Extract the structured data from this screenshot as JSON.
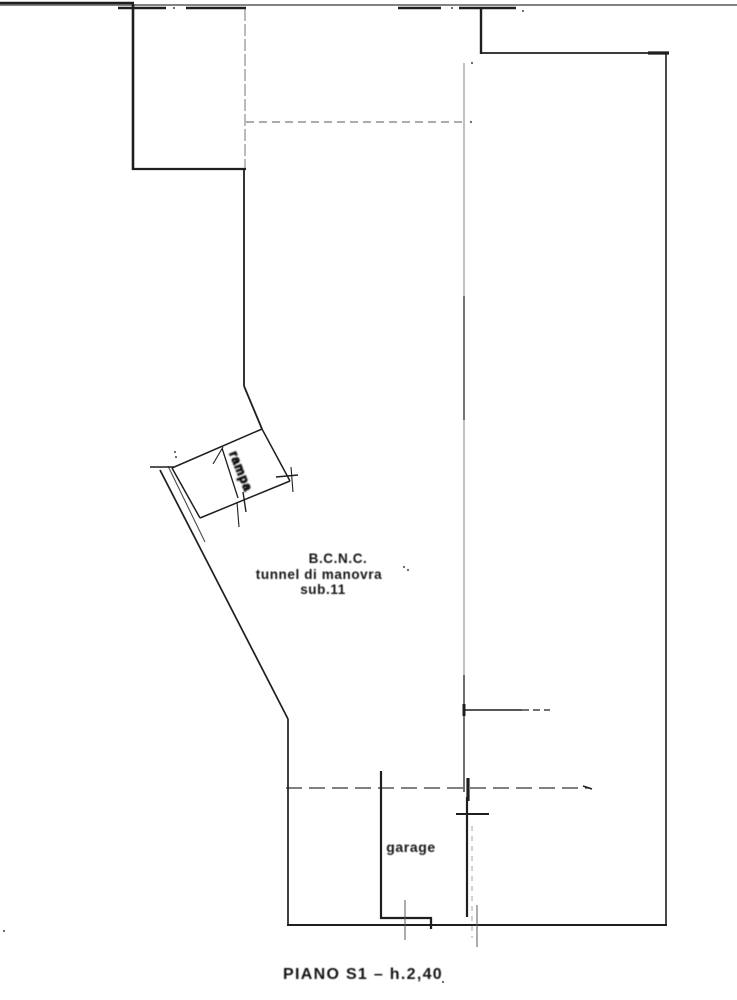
{
  "page": {
    "width": 737,
    "height": 1000,
    "background": "#ffffff"
  },
  "drawing": {
    "kind": "cadastral-floor-plan",
    "caption": "PIANO S1 – h.2,40",
    "unit_label_lines": [
      "B.C.N.C.",
      "tunnel di manovra",
      "sub.11"
    ],
    "garage_label": "garage",
    "ramp_label": "rampa"
  },
  "colors": {
    "ink": "#1f1f1f",
    "soft": "#5a5a5a",
    "paper": "#ffffff"
  },
  "plan": {
    "lines": [
      {
        "x1": 0,
        "y1": 5,
        "x2": 737,
        "y2": 5,
        "w": 1.5,
        "c": "soft",
        "n": "sheet-top-border"
      },
      {
        "x1": 0,
        "y1": 3,
        "x2": 134,
        "y2": 3,
        "w": 2.6,
        "n": "sheet-top-border-dark"
      },
      {
        "x1": 118,
        "y1": 8,
        "x2": 166,
        "y2": 8,
        "w": 2.6,
        "n": "top-wall-segment"
      },
      {
        "x1": 186,
        "y1": 8,
        "x2": 246,
        "y2": 8,
        "w": 2.6,
        "n": "top-wall-segment"
      },
      {
        "x1": 398,
        "y1": 8,
        "x2": 441,
        "y2": 8,
        "w": 2.6,
        "n": "top-wall-segment"
      },
      {
        "x1": 459,
        "y1": 8,
        "x2": 516,
        "y2": 8,
        "w": 2.6,
        "n": "top-wall-segment"
      },
      {
        "x1": 133,
        "y1": 4,
        "x2": 133,
        "y2": 170,
        "w": 2.6,
        "n": "room-wall-left"
      },
      {
        "x1": 132,
        "y1": 169,
        "x2": 246,
        "y2": 169,
        "w": 2.3,
        "n": "room-wall-bottom"
      },
      {
        "x1": 245,
        "y1": 9,
        "x2": 245,
        "y2": 168,
        "w": 1.1,
        "c": "soft",
        "o": 0.75,
        "d": "12,3",
        "n": "room-wall-right-thin"
      },
      {
        "x1": 244,
        "y1": 169,
        "x2": 244,
        "y2": 386,
        "w": 1.8,
        "n": "tunnel-wall-left"
      },
      {
        "x1": 244,
        "y1": 386,
        "x2": 262,
        "y2": 429,
        "w": 1.8,
        "n": "tunnel-wall-kink"
      },
      {
        "x1": 481,
        "y1": 7,
        "x2": 481,
        "y2": 54,
        "w": 2.4,
        "n": "top-right-wall-vertical"
      },
      {
        "x1": 480,
        "y1": 53,
        "x2": 668,
        "y2": 53,
        "w": 1.8,
        "n": "top-right-wall-horizontal"
      },
      {
        "x1": 648,
        "y1": 53,
        "x2": 669,
        "y2": 53,
        "w": 3.2,
        "n": "wall-tick"
      },
      {
        "x1": 666,
        "y1": 53,
        "x2": 666,
        "y2": 925,
        "w": 1.6,
        "n": "outer-wall-right"
      },
      {
        "x1": 262,
        "y1": 429,
        "x2": 172,
        "y2": 468,
        "w": 1.5,
        "n": "ramp-edge-top"
      },
      {
        "x1": 172,
        "y1": 468,
        "x2": 200,
        "y2": 518,
        "w": 1.5,
        "n": "ramp-edge-left"
      },
      {
        "x1": 200,
        "y1": 518,
        "x2": 290,
        "y2": 481,
        "w": 1.5,
        "n": "ramp-edge-bottom"
      },
      {
        "x1": 290,
        "y1": 481,
        "x2": 262,
        "y2": 429,
        "w": 1.5,
        "n": "ramp-edge-right"
      },
      {
        "x1": 222,
        "y1": 448,
        "x2": 238,
        "y2": 498,
        "w": 1.3,
        "n": "ramp-division-line"
      },
      {
        "x1": 213,
        "y1": 464,
        "x2": 223,
        "y2": 447,
        "w": 1.1,
        "n": "ramp-mark"
      },
      {
        "x1": 150,
        "y1": 467,
        "x2": 174,
        "y2": 467,
        "w": 1.4,
        "n": "wall-tick"
      },
      {
        "x1": 276,
        "y1": 477,
        "x2": 298,
        "y2": 475,
        "w": 1.4,
        "n": "wall-tick"
      },
      {
        "x1": 291,
        "y1": 467,
        "x2": 293,
        "y2": 492,
        "w": 1.1,
        "n": "wall-tick"
      },
      {
        "x1": 243,
        "y1": 492,
        "x2": 246,
        "y2": 512,
        "w": 1.4,
        "n": "ramp-mark"
      },
      {
        "x1": 237,
        "y1": 502,
        "x2": 239,
        "y2": 527,
        "w": 1.1,
        "n": "ramp-mark"
      },
      {
        "x1": 160,
        "y1": 470,
        "x2": 288,
        "y2": 719,
        "w": 1.7,
        "n": "outer-wall-diagonal"
      },
      {
        "x1": 168,
        "y1": 466,
        "x2": 205,
        "y2": 542,
        "w": 1.1,
        "o": 0.8,
        "n": "outer-wall-diagonal-inner"
      },
      {
        "x1": 288,
        "y1": 719,
        "x2": 288,
        "y2": 926,
        "w": 1.7,
        "n": "outer-wall-left"
      },
      {
        "x1": 287,
        "y1": 925,
        "x2": 667,
        "y2": 925,
        "w": 1.9,
        "n": "outer-wall-bottom"
      },
      {
        "x1": 381,
        "y1": 771,
        "x2": 381,
        "y2": 919,
        "w": 2.2,
        "n": "garage-wall-left"
      },
      {
        "x1": 380,
        "y1": 918,
        "x2": 432,
        "y2": 918,
        "w": 2.3,
        "n": "garage-sill"
      },
      {
        "x1": 431,
        "y1": 917,
        "x2": 431,
        "y2": 929,
        "w": 2.3,
        "n": "garage-sill-step"
      },
      {
        "x1": 467,
        "y1": 797,
        "x2": 467,
        "y2": 917,
        "w": 2.2,
        "n": "garage-wall-right"
      },
      {
        "x1": 456,
        "y1": 814,
        "x2": 489,
        "y2": 814,
        "w": 2,
        "n": "garage-door-jamb"
      },
      {
        "x1": 468,
        "y1": 778,
        "x2": 468,
        "y2": 801,
        "w": 3.2,
        "n": "garage-door-post"
      },
      {
        "x1": 405,
        "y1": 900,
        "x2": 405,
        "y2": 940,
        "w": 1,
        "c": "soft",
        "n": "survey-tick"
      },
      {
        "x1": 477,
        "y1": 905,
        "x2": 477,
        "y2": 947,
        "w": 1,
        "c": "soft",
        "n": "survey-tick"
      },
      {
        "x1": 472,
        "y1": 826,
        "x2": 472,
        "y2": 938,
        "w": 0.9,
        "c": "soft",
        "d": "5,5",
        "o": 0.6,
        "n": "survey-tick"
      },
      {
        "x1": 246,
        "y1": 122,
        "x2": 464,
        "y2": 122,
        "w": 1.1,
        "c": "soft",
        "d": "8,5",
        "n": "dashed-boundary-upper"
      },
      {
        "x1": 464,
        "y1": 63,
        "x2": 464,
        "y2": 792,
        "w": 1,
        "c": "soft",
        "o": 0.75,
        "n": "boundary-vertical"
      },
      {
        "x1": 464,
        "y1": 296,
        "x2": 464,
        "y2": 420,
        "w": 1.4,
        "o": 0.8,
        "n": "boundary-vertical-dark"
      },
      {
        "x1": 464,
        "y1": 675,
        "x2": 464,
        "y2": 792,
        "w": 1.4,
        "o": 0.85,
        "n": "boundary-vertical-dark"
      },
      {
        "x1": 464,
        "y1": 704,
        "x2": 464,
        "y2": 716,
        "w": 3,
        "n": "wall-tick"
      },
      {
        "x1": 464,
        "y1": 710,
        "x2": 522,
        "y2": 710,
        "w": 1.5,
        "n": "boundary-horizontal"
      },
      {
        "x1": 522,
        "y1": 710,
        "x2": 550,
        "y2": 710,
        "w": 1.3,
        "d": "7,4",
        "n": "boundary-horizontal"
      },
      {
        "x1": 286,
        "y1": 788,
        "x2": 590,
        "y2": 788,
        "w": 1.2,
        "d": "16,7",
        "o": 0.9,
        "n": "dashed-boundary-lower"
      },
      {
        "x1": 583,
        "y1": 786,
        "x2": 592,
        "y2": 789,
        "w": 1.6,
        "n": "wall-tick"
      }
    ],
    "specks": [
      [
        174,
        8
      ],
      [
        452,
        8
      ],
      [
        523,
        11
      ],
      [
        472,
        63
      ],
      [
        471,
        122
      ],
      [
        404,
        567
      ],
      [
        408,
        570
      ],
      [
        175,
        452
      ],
      [
        176,
        457
      ],
      [
        4,
        931
      ],
      [
        443,
        982
      ]
    ],
    "svg_texts": [
      {
        "bind": "drawing.ramp_label",
        "x": 237,
        "y": 473,
        "s": 12.5,
        "rotate": 68,
        "n": "ramp-label"
      }
    ]
  }
}
